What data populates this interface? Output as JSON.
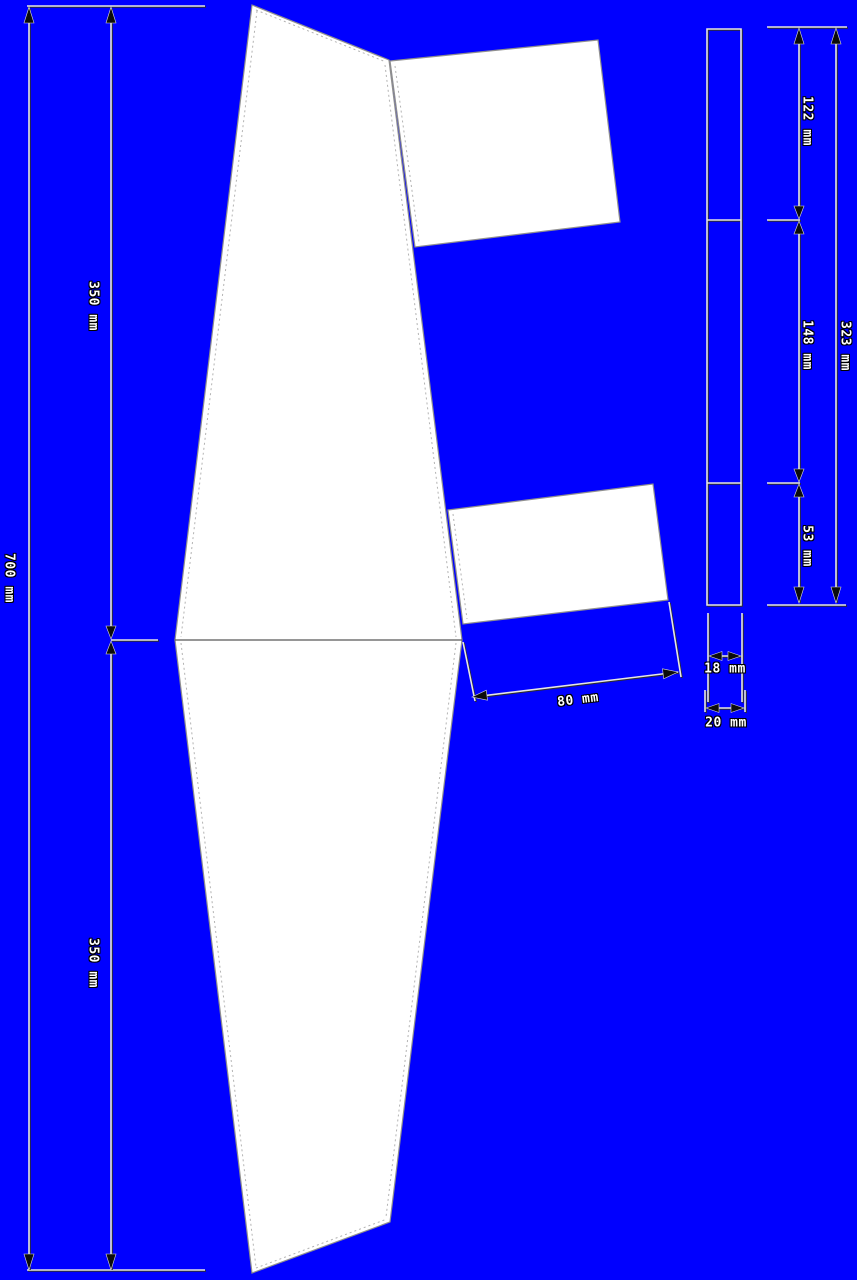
{
  "drawing": {
    "background_color": "#0000ff",
    "panel_fill_color": "#ffffff",
    "dimension_unit": "mm"
  },
  "dimensions": {
    "span_total": "700 mm",
    "span_upper_half": "350 mm",
    "span_lower_half": "350 mm",
    "strip_segment_top": "122 mm",
    "strip_segment_middle": "148 mm",
    "strip_segment_bottom": "53 mm",
    "strip_total": "323 mm",
    "strip_width_inner": "18 mm",
    "strip_width_outer": "20 mm",
    "flap_chord": "80 mm"
  }
}
